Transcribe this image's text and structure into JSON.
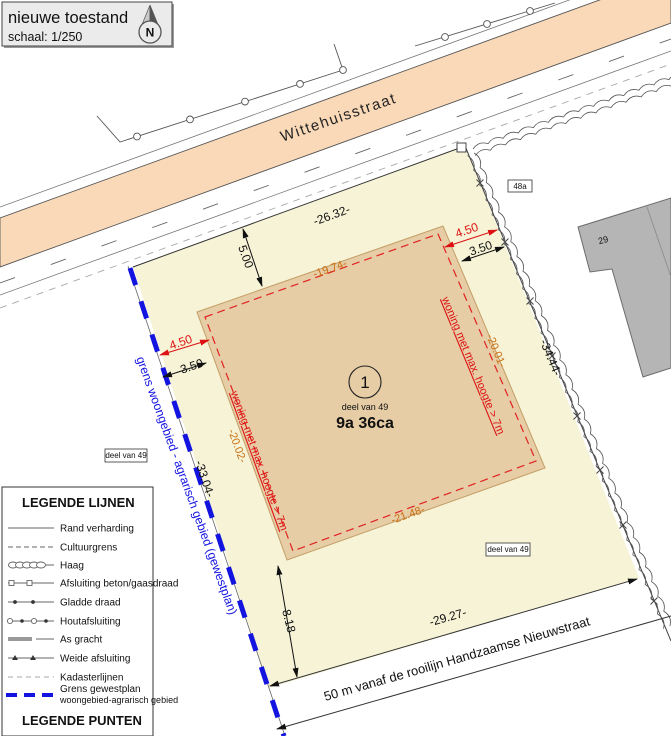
{
  "title_box": {
    "title": "nieuwe toestand",
    "scale": "schaal: 1/250",
    "north_letter": "N"
  },
  "street": {
    "name": "Wittehuisstraat"
  },
  "plot": {
    "number": "1",
    "part_label": "deel van 49",
    "area": "9a 36ca",
    "part_label_left": "deel van 49",
    "part_label_right": "deel van 49",
    "neighbor_48a": "48a",
    "neighbor_29": "29",
    "zone_label_left": "woning met max. hoogte > 7m",
    "zone_label_right": "woning met max. hoogte > 7m",
    "boundary_label": "grens woongebied - agrarisch gebied (gewestplan)",
    "frontage_label": "50 m vanaf de rooilijn Handzaamse Nieuwstraat"
  },
  "dimensions": {
    "street_frontage": "-26.32-",
    "front_setback": "5.00",
    "zone_top": "-19.74-",
    "zone_bottom": "-21.48-",
    "zone_left": "-20.02-",
    "zone_right": "-20.01-",
    "side_right": "-34.44-",
    "side_left": "-33.04-",
    "bottom": "-29.27-",
    "rear_setback": "8.18",
    "offset_left_red": "4.50",
    "offset_left_black": "3.50",
    "offset_right_red": "4.50",
    "offset_right_black": "3.50"
  },
  "legend": {
    "lines_heading": "LEGENDE LIJNEN",
    "points_heading": "LEGENDE PUNTEN",
    "items": [
      {
        "label": "Rand verharding"
      },
      {
        "label": "Cultuurgrens"
      },
      {
        "label": "Haag"
      },
      {
        "label": "Afsluiting beton/gaasdraad"
      },
      {
        "label": "Gladde draad"
      },
      {
        "label": "Houtafsluiting"
      },
      {
        "label": "As gracht"
      },
      {
        "label": "Weide afsluiting"
      },
      {
        "label": "Kadasterlijnen"
      },
      {
        "label": "Grens gewestplan",
        "label2": "woongebied-agrarisch gebied"
      }
    ]
  },
  "colors": {
    "street": "#f9d9b8",
    "parcel": "#f6f3d6",
    "zone": "#e6cda6",
    "zone_outline": "#e02222",
    "boundary_blue": "#1414e0",
    "dim_orange": "#c96f12",
    "dim_red": "#dd1111",
    "building": "#b5b5b5"
  }
}
